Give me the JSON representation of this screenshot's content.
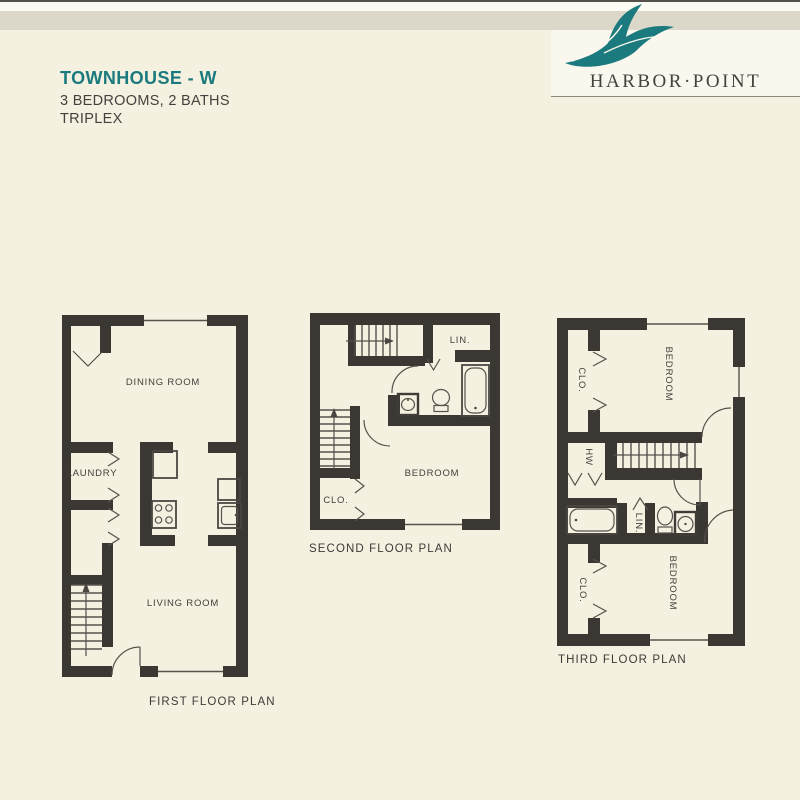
{
  "header": {
    "title": "TOWNHOUSE - W",
    "specs": "3 BEDROOMS, 2 BATHS",
    "unit_type": "TRIPLEX",
    "brand": "HARBOR·POINT"
  },
  "floor1": {
    "caption": "FIRST FLOOR PLAN",
    "dining": "DINING ROOM",
    "laundry": "LAUNDRY",
    "living": "LIVING ROOM"
  },
  "floor2": {
    "caption": "SECOND FLOOR PLAN",
    "linen": "LIN.",
    "closet": "CLO.",
    "bedroom": "BEDROOM"
  },
  "floor3": {
    "caption": "THIRD FLOOR PLAN",
    "closet_top": "CLO.",
    "bedroom_top": "BEDROOM",
    "water_heater": "HW",
    "linen": "LIN.",
    "closet_bottom": "CLO.",
    "bedroom_bottom": "BEDROOM"
  },
  "colors": {
    "teal": "#1b7a7d",
    "wall": "#3b3834",
    "page": "#f4f1e1"
  }
}
